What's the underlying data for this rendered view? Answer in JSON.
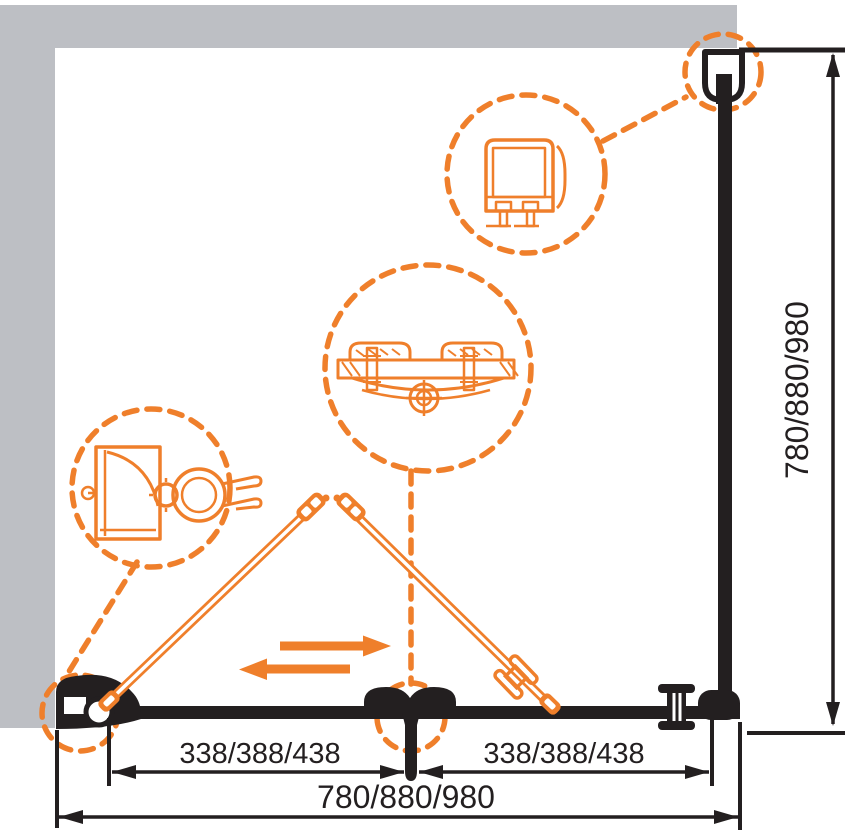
{
  "dimensions": {
    "segment_left_label": "338/388/438",
    "segment_right_label": "338/388/438",
    "total_width_label": "780/880/980",
    "total_height_label": "780/880/980"
  },
  "colors": {
    "accent_orange": "#EF7F2B",
    "wall_gray": "#BDBFC4",
    "line_black": "#231F20"
  }
}
